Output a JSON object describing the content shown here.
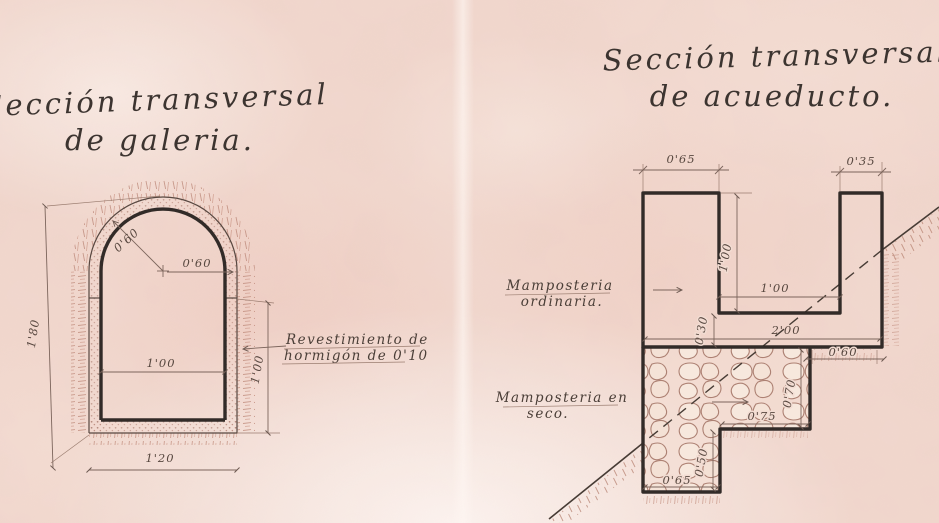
{
  "left": {
    "title1": "Sección transversal",
    "title2": "de galeria.",
    "note1": "Revestimiento de",
    "note2": "hormigón de 0'10",
    "dim_radius_diag": "0'60",
    "dim_radius_horiz": "0'60",
    "dim_height": "1'80",
    "dim_inner_width": "1'00",
    "dim_wall_height": "1'00",
    "dim_outer_width": "1'20"
  },
  "right": {
    "title1": "Sección transversal",
    "title2": "de acueducto.",
    "masonry_ordinary_1": "Mamposteria",
    "masonry_ordinary_2": "ordinaria.",
    "masonry_dry_1": "Mamposteria en",
    "masonry_dry_2": "seco.",
    "dim_left_wall": "0'65",
    "dim_right_wall": "0'35",
    "dim_depth": "1'00",
    "dim_width": "1'00",
    "dim_slab": "0'30",
    "dim_total": "2'00",
    "dim_ledge": "0'60",
    "dim_found_h": "0'70",
    "dim_found_w": "0'75",
    "dim_foot_h": "0'50",
    "dim_foot_w": "0'65"
  },
  "colors": {
    "paper": "#f0d5cb",
    "ink": "#3c3430",
    "dimension": "#7c655c",
    "hatch": "#c28f80"
  }
}
